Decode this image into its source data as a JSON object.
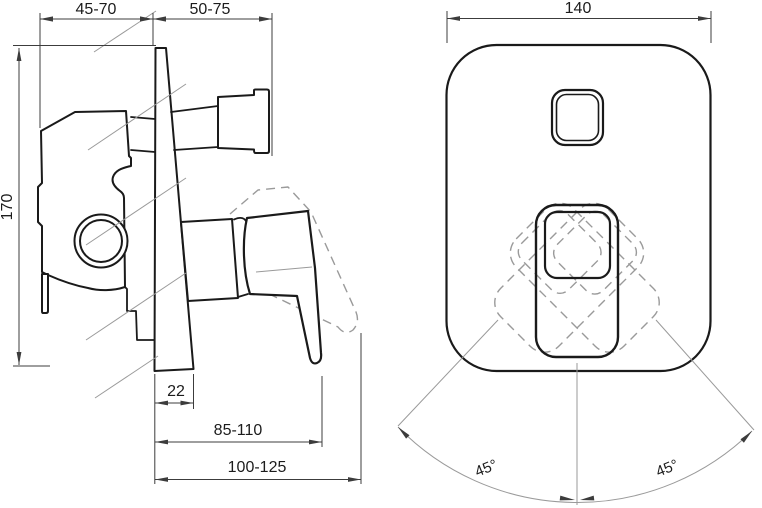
{
  "drawing": {
    "title": "Concealed shower mixer installation dimensions",
    "side_view": {
      "depth_behind_wall": "45-70",
      "depth_in_front": "50-75",
      "body_height": "170",
      "plate_thickness": "22",
      "handle_projection": "85-110",
      "handle_projection_max": "100-125"
    },
    "front_view": {
      "plate_width": "140",
      "handle_swing_left": "45°",
      "handle_swing_right": "45°"
    },
    "colors": {
      "outline": "#1a1a1a",
      "dimension": "#3c3c3c",
      "construction": "#9a9a9a"
    }
  }
}
